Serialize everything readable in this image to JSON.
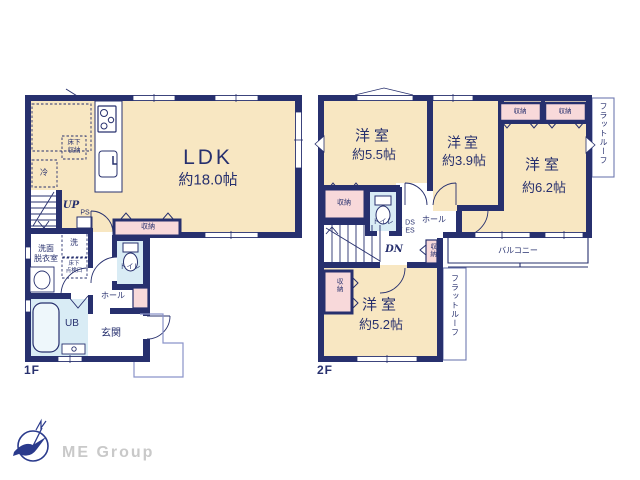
{
  "colors": {
    "wall": "#27306e",
    "room_fill": "#f8e7c2",
    "closet_fill": "#f8d9da",
    "wet_fill": "#d9ecf5",
    "thin_line": "#6f79b0",
    "logo_text": "#c9c9c9",
    "logo_mark": "#2a3a8c"
  },
  "floor1": {
    "label": "1F",
    "ldk": {
      "name": "LDK",
      "area": "約18.0帖"
    },
    "labels": {
      "underfloor_l1": "床下",
      "underfloor_l2": "収納",
      "fridge": "冷",
      "up": "UP",
      "ps": "PS",
      "closet": "収納",
      "toilet": "トイレ",
      "laundry": "洗",
      "washroom_l1": "洗面",
      "washroom_l2": "脱衣室",
      "hatch_l1": "床下",
      "hatch_l2": "点検口",
      "bath": "UB",
      "hall": "ホール",
      "entrance": "玄関"
    }
  },
  "floor2": {
    "label": "2F",
    "rooms": [
      {
        "name": "洋室",
        "area": "約5.5帖"
      },
      {
        "name": "洋室",
        "area": "約3.9帖"
      },
      {
        "name": "洋室",
        "area": "約6.2帖"
      },
      {
        "name": "洋室",
        "area": "約5.2帖"
      }
    ],
    "labels": {
      "closet": "収納",
      "toilet": "トイレ",
      "hall": "ホール",
      "dn": "DN",
      "ds": "DS",
      "es": "ES",
      "balcony": "バルコニー",
      "flat_roof": "フラットルーフ"
    }
  },
  "branding": {
    "company": "ME Group"
  }
}
